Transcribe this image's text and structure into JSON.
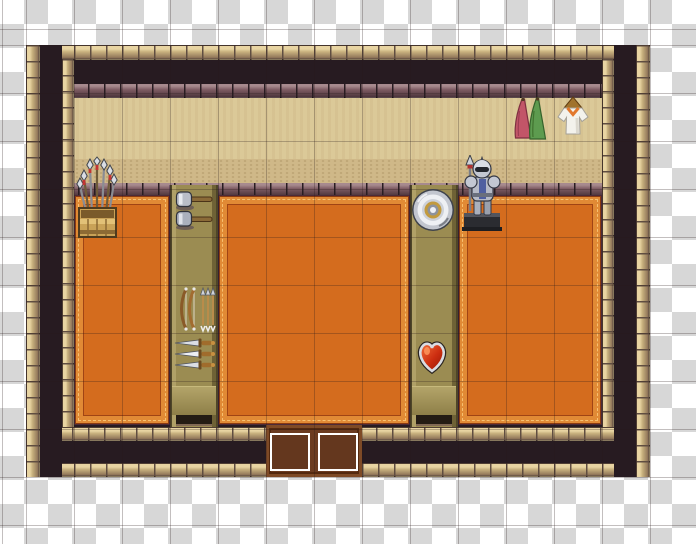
{
  "scene": {
    "type": "rpg-maker-style weapon shop interior map on transparent checkerboard",
    "visible_text": "none"
  },
  "canvas": {
    "width": 696,
    "height": 544
  },
  "checker": {
    "cell": 24,
    "light": "#ffffff",
    "dark": "#d7d7d7"
  },
  "grid": {
    "cell": 48,
    "offset_x": 26,
    "offset_y": 45,
    "line": "rgba(40,25,25,0.28)"
  },
  "map": {
    "x": 26,
    "y": 45,
    "cols": 13,
    "rows": 9,
    "tile": 48
  },
  "palette": {
    "checker_light": "#ffffff",
    "checker_dark": "#d7d7d7",
    "grid_line": "rgba(40,25,25,0.28)",
    "wall_dark": "#271b21",
    "stone_tan": "#c8b17e",
    "stone_tan_hi": "#e8d4a2",
    "stone_tan_lo": "#93785b",
    "stone_gap": "#5f4d41",
    "stone_mauve": "#7d5b62",
    "stone_mauve_hi": "#a78a8e",
    "stone_mauve_lo": "#4b343b",
    "stone_mauve_gap": "#291d22",
    "floor_tan": "#dbc998",
    "floor_tan_edge": "#cfb888",
    "floor_tan_dot": "#b9a071",
    "carpet_body": "#d46c1e",
    "carpet_band": "#e18a35",
    "carpet_band_dark": "#a04414",
    "carpet_stitch": "#f6c070",
    "carpet_outline": "#4c2b38",
    "carpet_inner_line": "#8a3a10",
    "counter_body": "#9b8c52",
    "counter_hi": "#b0a167",
    "counter_lo": "#6f6236",
    "counter_edge": "#4f4628",
    "counter_face": "#b3a469",
    "counter_slot": "#241c14",
    "door_body": "#6b3b20",
    "door_hi": "#7e4a26",
    "door_lo": "#54290f",
    "event_outline": "#ffffff"
  },
  "regions": [
    {
      "name": "wall-base",
      "type": "wall-dark",
      "x": 26,
      "y": 45,
      "w": 624,
      "h": 432
    },
    {
      "name": "upper-walkway-floor",
      "type": "floor-tan",
      "x": 62,
      "y": 97,
      "w": 540,
      "h": 92
    },
    {
      "name": "upper-walkway-edge",
      "type": "floor-tan-edge",
      "x": 62,
      "y": 159,
      "w": 540,
      "h": 26
    },
    {
      "name": "platform-ledge",
      "type": "trim-mauve",
      "x": 62,
      "y": 183,
      "w": 540,
      "h": 14
    },
    {
      "name": "carpet-left",
      "type": "carpet",
      "x": 74,
      "y": 195,
      "w": 96,
      "h": 230
    },
    {
      "name": "carpet-middle",
      "type": "carpet",
      "x": 218,
      "y": 195,
      "w": 192,
      "h": 230
    },
    {
      "name": "carpet-right",
      "type": "carpet",
      "x": 458,
      "y": 195,
      "w": 144,
      "h": 230
    },
    {
      "name": "wall-top-outer-trim",
      "type": "trim-tan-h",
      "x": 26,
      "y": 45,
      "w": 624,
      "h": 15
    },
    {
      "name": "wall-top-inner-trim",
      "type": "trim-mauve",
      "x": 40,
      "y": 84,
      "w": 596,
      "h": 14
    },
    {
      "name": "wall-bottom-inner-trim",
      "type": "trim-tan-h",
      "x": 40,
      "y": 427,
      "w": 596,
      "h": 14
    },
    {
      "name": "wall-bottom-dark",
      "type": "wall-dark",
      "x": 26,
      "y": 441,
      "w": 624,
      "h": 22
    },
    {
      "name": "wall-bottom-outer-trim",
      "type": "trim-tan-h",
      "x": 26,
      "y": 463,
      "w": 624,
      "h": 14
    },
    {
      "name": "wall-left-outer-trim",
      "type": "trim-tan-v",
      "x": 26,
      "y": 45,
      "w": 14,
      "h": 432
    },
    {
      "name": "wall-left-dark",
      "type": "wall-dark",
      "x": 40,
      "y": 45,
      "w": 22,
      "h": 432
    },
    {
      "name": "wall-left-inner-trim",
      "type": "trim-tan-v",
      "x": 62,
      "y": 59,
      "w": 12,
      "h": 368
    },
    {
      "name": "wall-right-inner-trim",
      "type": "trim-tan-v",
      "x": 602,
      "y": 59,
      "w": 12,
      "h": 368
    },
    {
      "name": "wall-right-dark",
      "type": "wall-dark",
      "x": 614,
      "y": 45,
      "w": 22,
      "h": 432
    },
    {
      "name": "wall-right-outer-trim",
      "type": "trim-tan-v",
      "x": 636,
      "y": 45,
      "w": 14,
      "h": 432
    },
    {
      "name": "doorway-floor",
      "type": "door",
      "x": 266,
      "y": 425,
      "w": 96,
      "h": 52
    },
    {
      "name": "display-counter-left",
      "type": "counter",
      "x": 170,
      "y": 185,
      "w": 48,
      "h": 242
    },
    {
      "name": "display-counter-right",
      "type": "counter",
      "x": 410,
      "y": 185,
      "w": 48,
      "h": 242
    }
  ],
  "items": [
    {
      "kind": "spear-rack",
      "name": "spear-rack",
      "x": 75,
      "y": 156,
      "w": 44,
      "h": 84
    },
    {
      "kind": "hammers",
      "name": "warhammer-display",
      "x": 173,
      "y": 190,
      "w": 42,
      "h": 40
    },
    {
      "kind": "bows",
      "name": "bow-and-arrow-display",
      "x": 176,
      "y": 285,
      "w": 40,
      "h": 48
    },
    {
      "kind": "knives",
      "name": "sword-display",
      "x": 173,
      "y": 336,
      "w": 44,
      "h": 36
    },
    {
      "kind": "round-shield",
      "name": "round-shield-display",
      "x": 411,
      "y": 188,
      "w": 44,
      "h": 44
    },
    {
      "kind": "heart-shield",
      "name": "heart-shield-display",
      "x": 416,
      "y": 338,
      "w": 32,
      "h": 36
    },
    {
      "kind": "armor",
      "name": "armor-statue",
      "x": 461,
      "y": 155,
      "w": 42,
      "h": 80
    },
    {
      "kind": "cloths",
      "name": "hanging-cloths",
      "x": 509,
      "y": 97,
      "w": 38,
      "h": 44
    },
    {
      "kind": "tunic",
      "name": "hanging-tunic",
      "x": 554,
      "y": 96,
      "w": 38,
      "h": 42
    }
  ],
  "events": [
    {
      "name": "door-event-left",
      "x": 270,
      "y": 433,
      "w": 40,
      "h": 38
    },
    {
      "name": "door-event-right",
      "x": 318,
      "y": 433,
      "w": 40,
      "h": 38
    }
  ]
}
